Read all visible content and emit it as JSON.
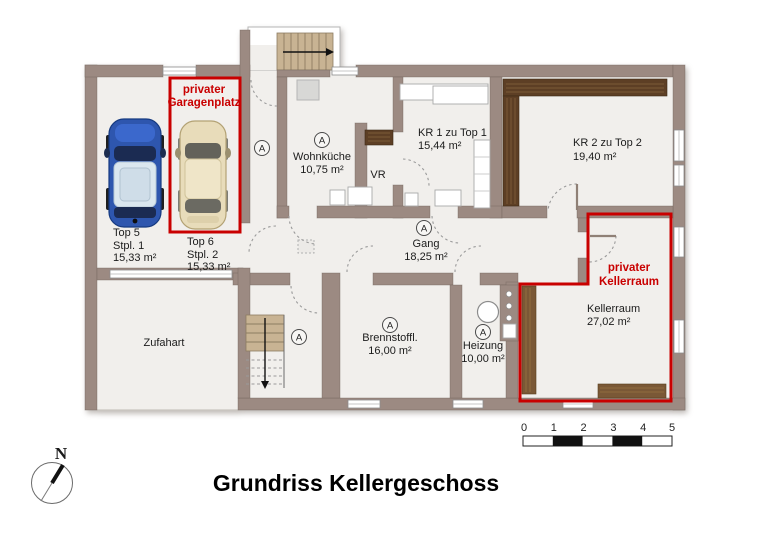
{
  "title": "Grundriss Kellergeschoss",
  "compass": {
    "north_label": "N"
  },
  "scale_bar": {
    "ticks": [
      "0",
      "1",
      "2",
      "3",
      "4",
      "5"
    ]
  },
  "door_marker": {
    "label": "A"
  },
  "highlights": {
    "garage": {
      "line1": "privater",
      "line2": "Garagenplatz"
    },
    "kellerraum": {
      "line1": "privater",
      "line2": "Kellerraum"
    }
  },
  "rooms": {
    "top5": {
      "name": "Top 5",
      "sub": "Stpl. 1",
      "area": "15,33 m²"
    },
    "top6": {
      "name": "Top 6",
      "sub": "Stpl. 2",
      "area": "15,33 m²"
    },
    "wohnkueche": {
      "name": "Wohnküche",
      "area": "10,75 m²"
    },
    "vr": {
      "name": "VR"
    },
    "kr1": {
      "name": "KR 1 zu Top 1",
      "area": "15,44 m²"
    },
    "kr2": {
      "name": "KR 2 zu Top 2",
      "area": "19,40 m²"
    },
    "gang": {
      "name": "Gang",
      "area": "18,25 m²"
    },
    "zufahart": {
      "name": "Zufahart"
    },
    "brennstoff": {
      "name": "Brennstoffl.",
      "area": "16,00 m²"
    },
    "heizung": {
      "name": "Heizung",
      "area": "10,00 m²"
    },
    "kellerraum": {
      "name": "Kellerraum",
      "area": "27,02 m²"
    }
  },
  "colors": {
    "wall": "#9c8a82",
    "floor": "#f1efec",
    "highlight_red": "#c90000",
    "wood_dark": "#5d3f25",
    "wood_medium": "#7a5836",
    "car_blue": "#2e56ae",
    "car_beige": "#e8dcba"
  }
}
